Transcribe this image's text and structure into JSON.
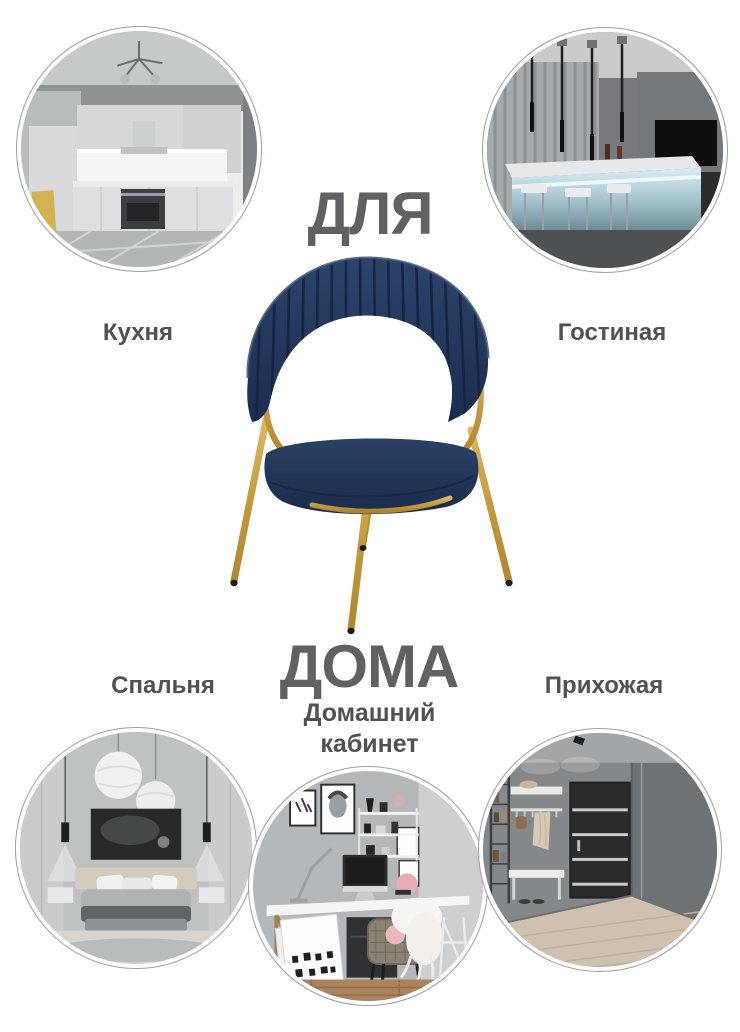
{
  "title": {
    "top_word": "ДЛЯ",
    "bottom_word": "ДОМА"
  },
  "rooms": [
    {
      "id": "kitchen",
      "label": "Кухня"
    },
    {
      "id": "living-room",
      "label": "Гостиная"
    },
    {
      "id": "bedroom",
      "label": "Спальня"
    },
    {
      "id": "home-office",
      "label": "Домашний кабинет"
    },
    {
      "id": "hallway",
      "label": "Прихожая"
    }
  ],
  "photos": [
    {
      "id": "kitchen-photo",
      "depicts": "white-gray kitchen with chandelier, oven and tiled floor"
    },
    {
      "id": "living-room-photo",
      "depicts": "dark bar counter with pendant lights, stools and backlit panel"
    },
    {
      "id": "bedroom-photo",
      "depicts": "gray bedroom with bed, wall art, sphere lamps and pendant spots"
    },
    {
      "id": "home-office-photo",
      "depicts": "desk with computer, lamp, shelves, rattan chair with sheepskin"
    },
    {
      "id": "hallway-photo",
      "depicts": "gray hallway with dark striped door, bench and coat rack"
    }
  ],
  "product": {
    "illustration": "navy-velvet-chair-gold-legs"
  },
  "colors": {
    "background": "#ffffff",
    "headline_text": "#5f6163",
    "label_text": "#4f5154",
    "circle_border": "#9aa0a4",
    "chair_navy": "#23395c",
    "chair_navy_dark": "#152544",
    "chair_gold": "#c9a24b"
  }
}
